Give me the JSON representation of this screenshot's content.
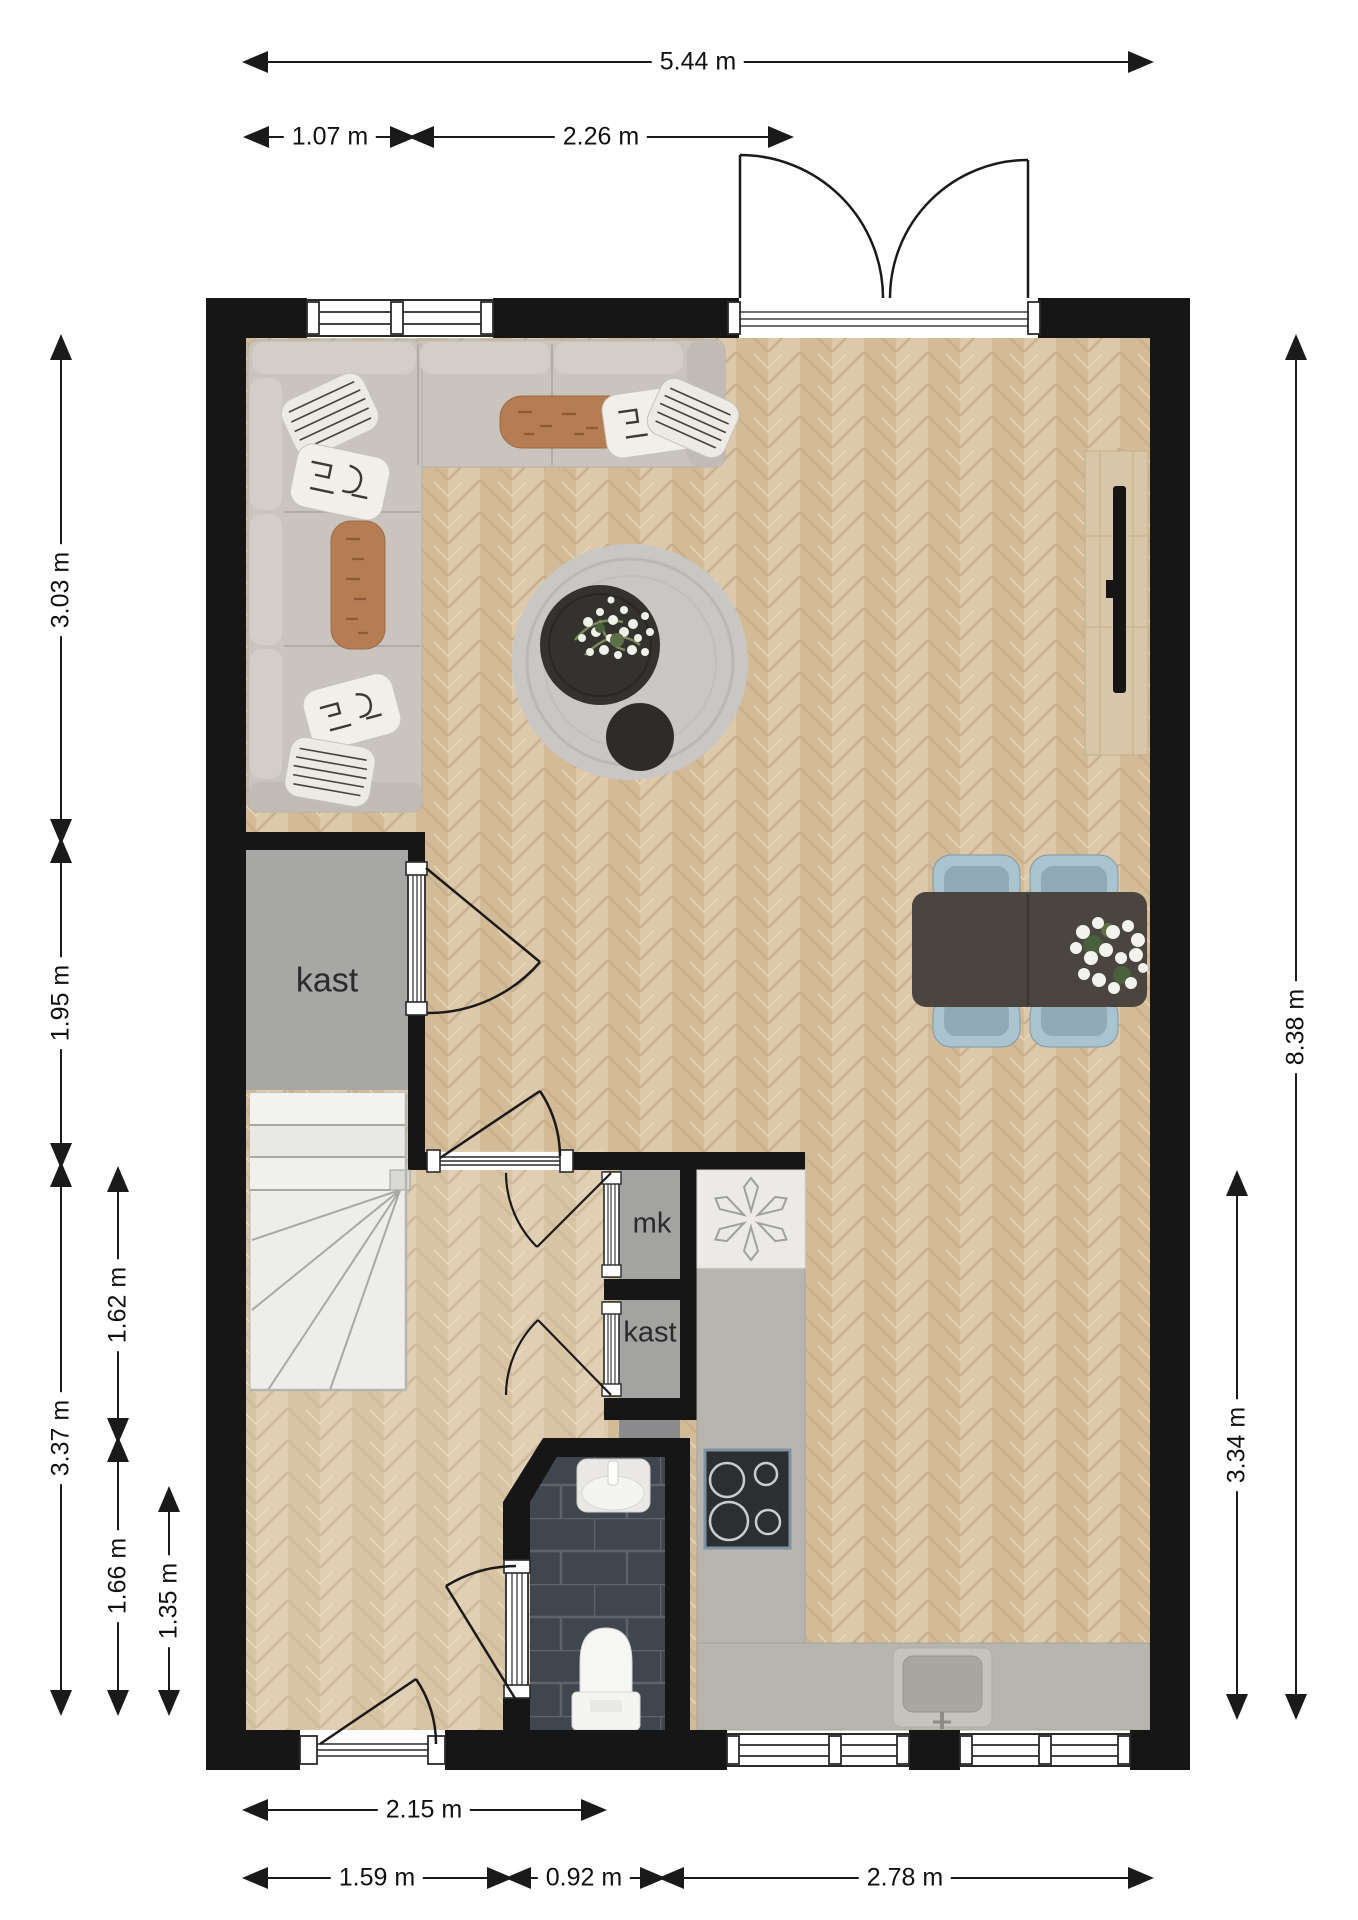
{
  "dimensions": {
    "top_total": "5.44 m",
    "top_seg1": "1.07 m",
    "top_seg2": "2.26 m",
    "left_seg1": "3.03 m",
    "left_seg2": "1.95 m",
    "left_seg3": "3.37 m",
    "left_inner1": "1.62 m",
    "left_inner2": "1.66 m",
    "left_inner3": "1.35 m",
    "right_total": "8.38 m",
    "right_seg": "3.34 m",
    "bottom_hall": "2.15 m",
    "bottom_seg1": "1.59 m",
    "bottom_seg2": "0.92 m",
    "bottom_seg3": "2.78 m"
  },
  "rooms": {
    "closet_large": "kast",
    "meter_cupboard": "mk",
    "closet_small": "kast"
  },
  "features": [
    "corner-sofa",
    "round-rug",
    "coffee-table",
    "plant",
    "tv-cabinet",
    "dining-table",
    "dining-chairs",
    "flower-bouquet",
    "staircase",
    "double-entry-door",
    "windows",
    "boiler",
    "cooktop",
    "kitchen-counter",
    "kitchen-sink",
    "bathroom",
    "wash-basin",
    "toilet"
  ],
  "colors": {
    "wall": "#161616",
    "floor": "#d9c3a2",
    "floor_seam": "#c8b08d",
    "closet_fill": "#a7a7a5",
    "stairs": "#ededeb",
    "sofa": "#c9c5be",
    "accent_pillow": "#b57d53",
    "rug": "#c9c7c3",
    "table": "#4b4540",
    "chair": "#a9c3cf",
    "counter": "#b8b5ae",
    "stove": "#2c2f31",
    "stove_border": "#7b93a2",
    "bath_tile": "#40464d",
    "dimension_text": "#111111"
  }
}
